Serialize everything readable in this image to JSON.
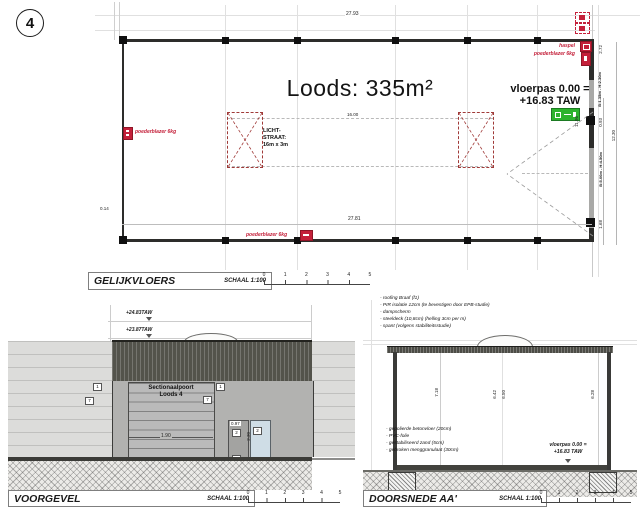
{
  "scale_ticks": [
    "0",
    "1",
    "2",
    "3",
    "4",
    "5"
  ],
  "sheet": {
    "number": "4"
  },
  "plan": {
    "title": "GELIJKVLOERS",
    "scale_label": "SCHAAL 1:100",
    "area_label": "Loods: 335m²",
    "dim_top": "27.93",
    "dim_bottom": "27.81",
    "lichtstraat": {
      "line1": "LICHT-",
      "line2": "STRAAT:",
      "line3": "16m x 3m",
      "dim": "16.00"
    },
    "vloerpas": {
      "line1": "vloerpas 0.00 =",
      "line2": "+16.83 TAW"
    },
    "labels": {
      "poederblazer": "poederblazer 6kg",
      "haspel": "haspel"
    },
    "dims_right": {
      "seg_top": "2.72",
      "window": "B:1.35m - H:2.30m",
      "seg_mid": "0.93",
      "gate": "B:5.00m - H:4.50m",
      "seg_bottom": "1.68",
      "total": "12.30",
      "inner": "11.96",
      "wall": "0.14"
    }
  },
  "voorgevel": {
    "title": "VOORGEVEL",
    "scale_label": "SCHAAL 1:100",
    "level_top": "+24.83TAW",
    "level_mid": "+23.87TAW",
    "door_line1": "Sectionaalpoort",
    "door_line2": "Loods 4",
    "dim_door_width": "1.90",
    "dim_side_door": "0.97",
    "dim_glass_door": "2.30",
    "tags": {
      "left_a": "1",
      "left_b": "7",
      "door_a": "1",
      "door_b": "7",
      "side_a": "2",
      "side_b": "2",
      "side_c": "5"
    }
  },
  "doorsnede": {
    "title": "DOORSNEDE AA'",
    "scale_label": "SCHAAL 1:100",
    "roof_notes": [
      "- roofing Braaf (f1)",
      "- PIR isolatie 12cm (te bevestigen door EPB-studie)",
      "- dampscherm",
      "- steeldeck (10,8cm) (helling 3cm per m)",
      "- spant (volgens stabiliteitsstudie)"
    ],
    "floor_notes": [
      "- gepolierde betonvloer (20cm)",
      "- PVC-folie",
      "- gestabiliseerd zand (5cm)",
      "- gebroken menggranulaat (30cm)"
    ],
    "vloerpas": {
      "line1": "vloerpas 0.00 =",
      "line2": "+16.83 TAW"
    },
    "dims": {
      "left": "7.18",
      "mid_a": "6.42",
      "mid_b": "6.50",
      "right": "6.28"
    }
  }
}
